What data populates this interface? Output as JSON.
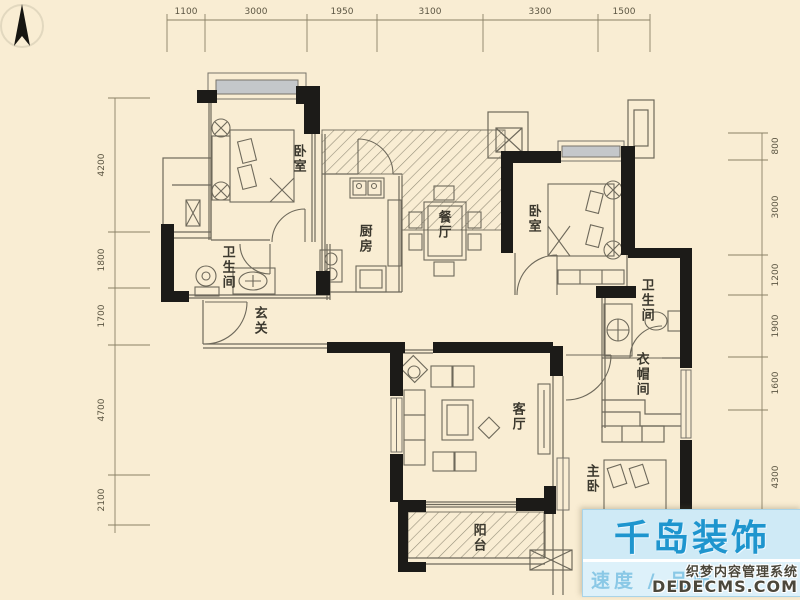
{
  "plan": {
    "type": "apartment-floor-plan",
    "dimensions": {
      "top": [
        "1100",
        "3000",
        "1950",
        "3100",
        "3300",
        "1500"
      ],
      "left": [
        "4200",
        "1800",
        "1700",
        "4700",
        "2100"
      ],
      "right": [
        "800",
        "3000",
        "1200",
        "1900",
        "1600",
        "4300"
      ]
    },
    "rooms": {
      "bedroom1": "卧室",
      "kitchen": "厨房",
      "dining": "餐厅",
      "bedroom2": "卧室",
      "bath1": "卫生间",
      "entry": "玄关",
      "living": "客厅",
      "bath2": "卫生间",
      "cloak": "衣帽间",
      "master": "主卧",
      "balcony": "阳台"
    },
    "colors": {
      "background": "#f9edd3",
      "wall": "#1c1b18",
      "thin_line": "#6e695b",
      "hatch": "#968f7a",
      "window_fill": "#c4c7ca",
      "dim_text": "#5c5643"
    }
  },
  "watermark": {
    "brand": "千岛装饰",
    "tagline": "速度 / 品质",
    "cms_line1": "织梦内容管理系统",
    "cms_line2": "DEDECMS.COM",
    "brand_color": "#1e95ce",
    "box_color": "#cfeaf6"
  }
}
